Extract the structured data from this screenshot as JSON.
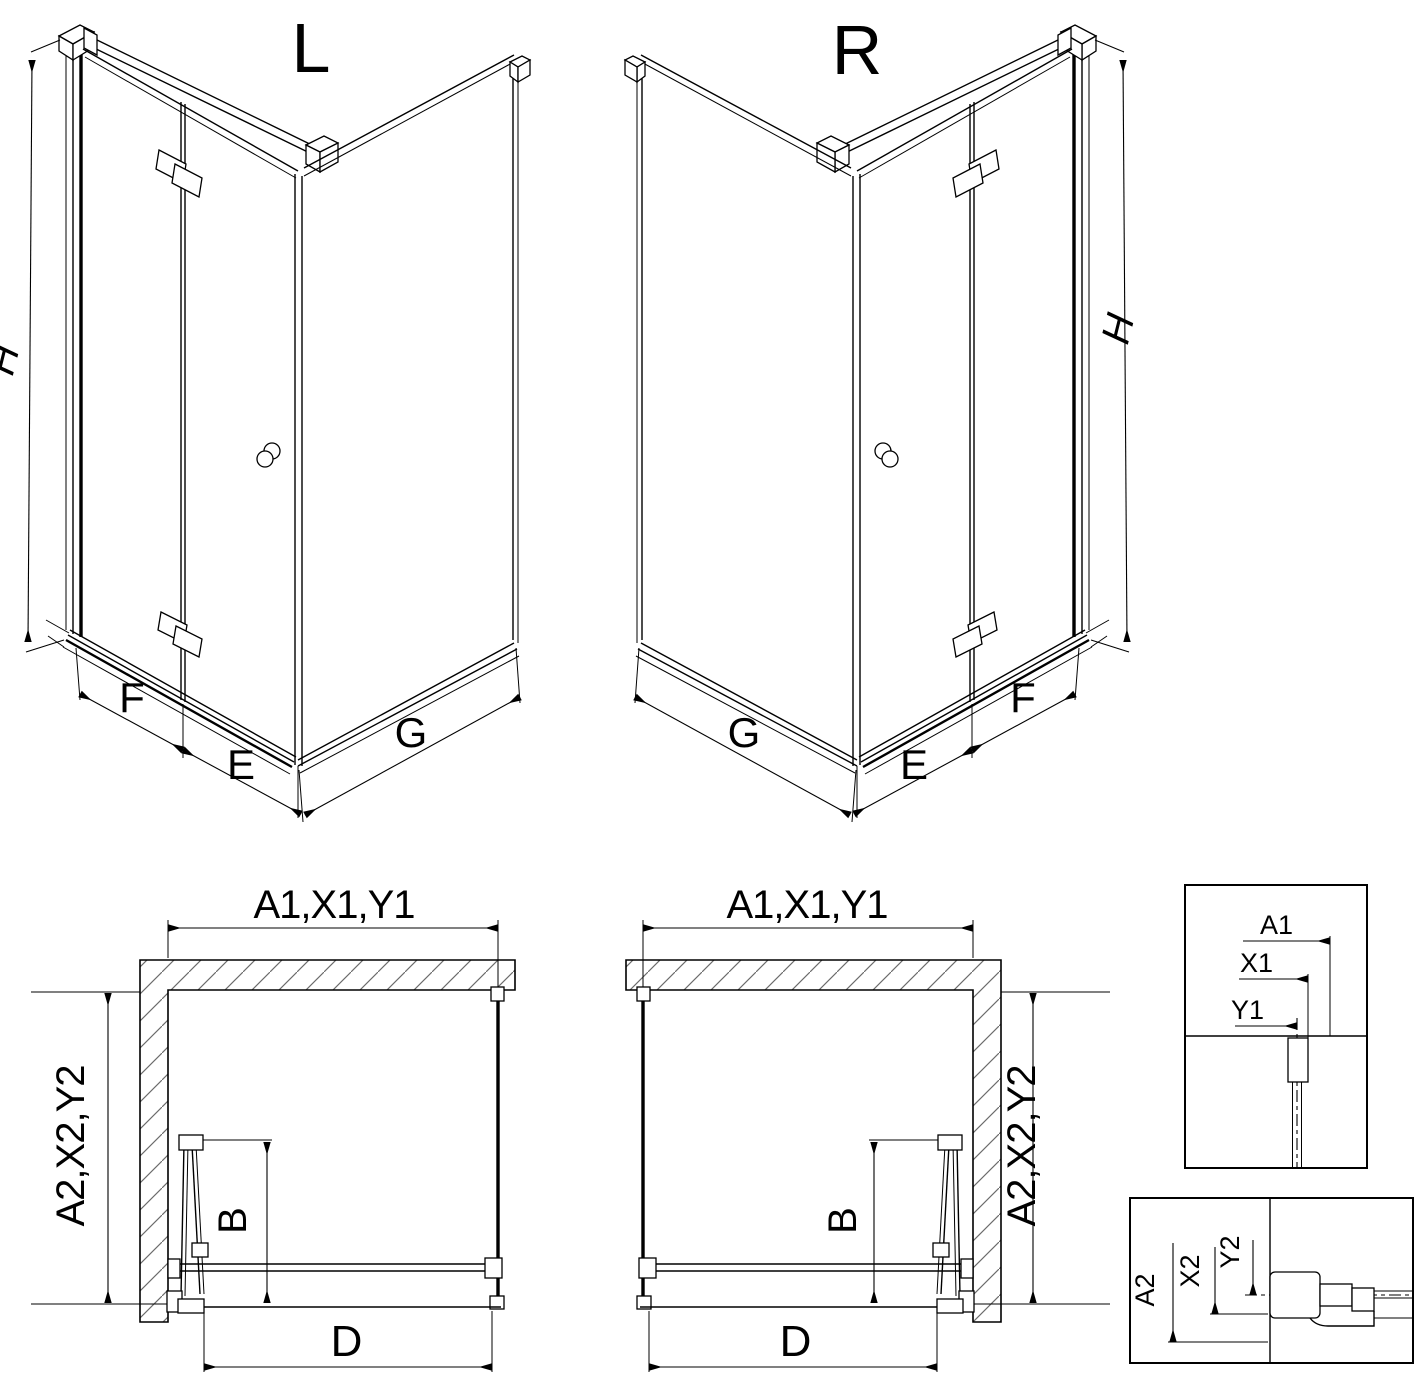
{
  "drawing": {
    "type": "shower-enclosure-technical-diagram",
    "colors": {
      "line": "#000000",
      "hatch": "#6a6a6a",
      "background": "#ffffff"
    }
  },
  "views": {
    "left_iso": {
      "label": "L",
      "height": "H",
      "panel_front": "F",
      "door": "E",
      "side": "G"
    },
    "right_iso": {
      "label": "R",
      "height": "H",
      "panel_front": "F",
      "door": "E",
      "side": "G"
    },
    "left_plan": {
      "width": "A1,X1,Y1",
      "depth": "A2,X2,Y2",
      "fold_depth": "B",
      "opening": "D"
    },
    "right_plan": {
      "width": "A1,X1,Y1",
      "depth": "A2,X2,Y2",
      "fold_depth": "B",
      "opening": "D"
    },
    "detail_top": {
      "dims": [
        "A1",
        "X1",
        "Y1"
      ]
    },
    "detail_bottom": {
      "dims": [
        "A2",
        "X2",
        "Y2"
      ]
    }
  }
}
